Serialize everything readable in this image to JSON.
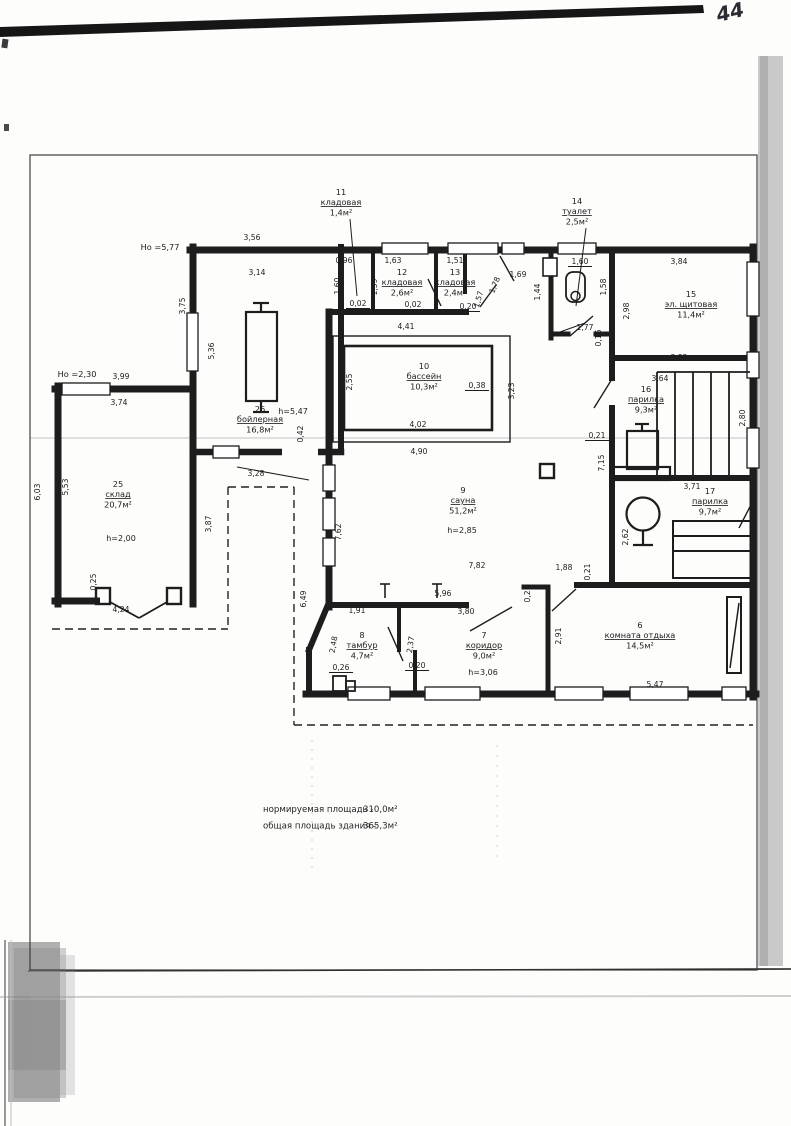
{
  "page": {
    "number": "44"
  },
  "notes": [
    {
      "label": "нормируемая площадь -",
      "value": "310,0м²"
    },
    {
      "label": "общая площадь здания -",
      "value": "365,3м²"
    }
  ],
  "elevations": [
    {
      "t": "Но =5,77",
      "x": 160,
      "y": 250
    },
    {
      "t": "Но =2,30",
      "x": 77,
      "y": 377
    }
  ],
  "rooms": [
    {
      "num": "11",
      "name": "кладовая",
      "area": "1,4м²",
      "x": 341,
      "y": 205
    },
    {
      "num": "14",
      "name": "туалет",
      "area": "2,5м²",
      "x": 577,
      "y": 214
    },
    {
      "num": "12",
      "name": "кладовая",
      "area": "2,6м²",
      "x": 402,
      "y": 285
    },
    {
      "num": "13",
      "name": "кладовая",
      "area": "2,4м²",
      "x": 455,
      "y": 285
    },
    {
      "num": "15",
      "name": "эл. щитовая",
      "area": "11,4м²",
      "x": 691,
      "y": 307
    },
    {
      "num": "16",
      "name": "парилка",
      "area": "9,3м²",
      "x": 646,
      "y": 402
    },
    {
      "num": "17",
      "name": "парилка",
      "area": "9,7м²",
      "x": 710,
      "y": 504
    },
    {
      "num": "10",
      "name": "бассейн",
      "area": "10,3м²",
      "x": 424,
      "y": 379
    },
    {
      "num": "26",
      "name": "бойлерная",
      "area": "16,8м²",
      "x": 260,
      "y": 422
    },
    {
      "num": "25",
      "name": "склад",
      "area": "20,7м²",
      "x": 118,
      "y": 497
    },
    {
      "num": "9",
      "name": "сауна",
      "area": "51,2м²",
      "x": 463,
      "y": 503
    },
    {
      "num": "8",
      "name": "тамбур",
      "area": "4,7м²",
      "x": 362,
      "y": 648
    },
    {
      "num": "7",
      "name": "коридор",
      "area": "9,0м²",
      "x": 484,
      "y": 648
    },
    {
      "num": "6",
      "name": "комната отдыха",
      "area": "14,5м²",
      "x": 640,
      "y": 638
    }
  ],
  "heights": [
    {
      "t": "h=5,47",
      "x": 293,
      "y": 414
    },
    {
      "t": "h=2,00",
      "x": 121,
      "y": 541
    },
    {
      "t": "h=2,85",
      "x": 462,
      "y": 533
    },
    {
      "t": "h=3,06",
      "x": 483,
      "y": 675
    }
  ],
  "dimensions": [
    {
      "t": "3,56",
      "x": 252,
      "y": 240
    },
    {
      "t": "3,14",
      "x": 257,
      "y": 275
    },
    {
      "t": "0,96",
      "x": 344,
      "y": 263
    },
    {
      "t": "1,63",
      "x": 393,
      "y": 263
    },
    {
      "t": "1,51",
      "x": 455,
      "y": 263
    },
    {
      "t": "1,69",
      "x": 518,
      "y": 277
    },
    {
      "t": "1,60",
      "x": 580,
      "y": 264,
      "u": 1
    },
    {
      "t": "3,84",
      "x": 679,
      "y": 264
    },
    {
      "t": "1,60",
      "x": 340,
      "y": 286,
      "r": -90
    },
    {
      "t": "1,59",
      "x": 377,
      "y": 287,
      "r": -90
    },
    {
      "t": "1,78",
      "x": 497,
      "y": 286,
      "r": -68
    },
    {
      "t": "1,57",
      "x": 481,
      "y": 300,
      "r": -75
    },
    {
      "t": "1,44",
      "x": 540,
      "y": 292,
      "r": -90
    },
    {
      "t": "1,58",
      "x": 606,
      "y": 287,
      "r": -90
    },
    {
      "t": "2,98",
      "x": 629,
      "y": 311,
      "r": -90
    },
    {
      "t": "0,02",
      "x": 358,
      "y": 306,
      "u": 1
    },
    {
      "t": "0,02",
      "x": 413,
      "y": 307,
      "u": 1
    },
    {
      "t": "0,20",
      "x": 468,
      "y": 309,
      "u": 1
    },
    {
      "t": "1,77",
      "x": 585,
      "y": 330
    },
    {
      "t": "0,16",
      "x": 601,
      "y": 338,
      "r": -90
    },
    {
      "t": "3,75",
      "x": 185,
      "y": 306,
      "r": -90
    },
    {
      "t": "5,36",
      "x": 214,
      "y": 351,
      "r": -90
    },
    {
      "t": "0,42",
      "x": 303,
      "y": 434,
      "r": -90
    },
    {
      "t": "4,41",
      "x": 406,
      "y": 329
    },
    {
      "t": "2,55",
      "x": 352,
      "y": 382,
      "r": -90
    },
    {
      "t": "0,38",
      "x": 477,
      "y": 388,
      "u": 1
    },
    {
      "t": "3,23",
      "x": 514,
      "y": 391,
      "r": -90
    },
    {
      "t": "4,02",
      "x": 418,
      "y": 427
    },
    {
      "t": "4,90",
      "x": 419,
      "y": 454
    },
    {
      "t": "3,82",
      "x": 679,
      "y": 360
    },
    {
      "t": "3,64",
      "x": 660,
      "y": 381
    },
    {
      "t": "2,80",
      "x": 745,
      "y": 418,
      "r": -90
    },
    {
      "t": "0,21",
      "x": 597,
      "y": 438,
      "u": 1
    },
    {
      "t": "7,15",
      "x": 604,
      "y": 463,
      "r": -90
    },
    {
      "t": "3,71",
      "x": 692,
      "y": 489
    },
    {
      "t": "2,62",
      "x": 628,
      "y": 537,
      "r": -90
    },
    {
      "t": "3,99",
      "x": 121,
      "y": 379
    },
    {
      "t": "3,74",
      "x": 119,
      "y": 405
    },
    {
      "t": "6,03",
      "x": 40,
      "y": 492,
      "r": -90
    },
    {
      "t": "5,53",
      "x": 68,
      "y": 487,
      "r": -90
    },
    {
      "t": "3,87",
      "x": 211,
      "y": 524,
      "r": -90
    },
    {
      "t": "0,25",
      "x": 96,
      "y": 582,
      "r": -90
    },
    {
      "t": "4,24",
      "x": 121,
      "y": 612
    },
    {
      "t": "3,28",
      "x": 256,
      "y": 476
    },
    {
      "t": "7,62",
      "x": 341,
      "y": 532,
      "r": -90
    },
    {
      "t": "6,49",
      "x": 306,
      "y": 599,
      "r": -90
    },
    {
      "t": "7,82",
      "x": 477,
      "y": 568
    },
    {
      "t": "1,88",
      "x": 564,
      "y": 570
    },
    {
      "t": "0,21",
      "x": 590,
      "y": 572,
      "r": -90
    },
    {
      "t": "0,21",
      "x": 530,
      "y": 594,
      "r": -90
    },
    {
      "t": "5,96",
      "x": 443,
      "y": 596
    },
    {
      "t": "1,91",
      "x": 357,
      "y": 613
    },
    {
      "t": "3,80",
      "x": 466,
      "y": 614
    },
    {
      "t": "2,48",
      "x": 336,
      "y": 645,
      "r": -80
    },
    {
      "t": "2,37",
      "x": 413,
      "y": 645,
      "r": -82
    },
    {
      "t": "0,26",
      "x": 341,
      "y": 670,
      "u": 1
    },
    {
      "t": "0,20",
      "x": 417,
      "y": 668,
      "u": 1
    },
    {
      "t": "2,91",
      "x": 561,
      "y": 636,
      "r": -90
    },
    {
      "t": "5,47",
      "x": 655,
      "y": 687
    }
  ]
}
